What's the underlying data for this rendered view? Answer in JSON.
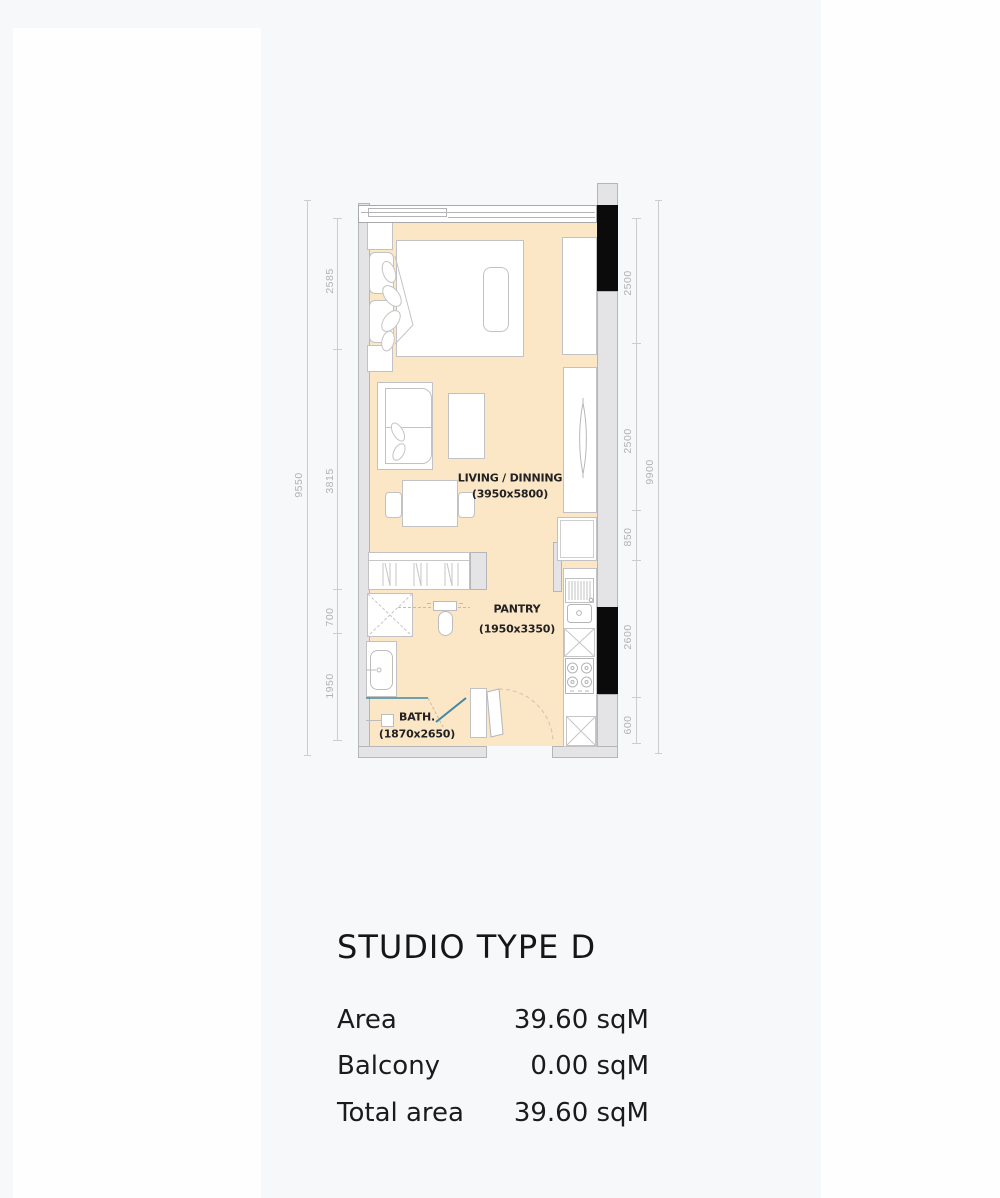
{
  "floorplan": {
    "rooms": {
      "living": {
        "name": "LIVING / DINNING",
        "size": "(3950x5800)"
      },
      "pantry": {
        "name": "PANTRY",
        "size": "(1950x3350)"
      },
      "bath": {
        "name": "BATH.",
        "size": "(1870x2650)"
      }
    },
    "dims": {
      "left_total": "9550",
      "left_1": "2585",
      "left_2": "3815",
      "left_3": "700",
      "left_4": "1950",
      "right_1": "2500",
      "right_2": "2500",
      "right_3": "850",
      "right_4": "2600",
      "right_5": "600",
      "right_total": "9900"
    },
    "colors": {
      "floor": "#fbe6c5",
      "wall": "#e4e4e6",
      "column": "#0b0b0b",
      "line": "#c2c2c4",
      "dim_text": "#b2b2b4",
      "accent_teal": "#3f88a5"
    }
  },
  "info": {
    "title": "STUDIO TYPE D",
    "rows": [
      {
        "label": "Area",
        "value": "39.60 sqM"
      },
      {
        "label": "Balcony",
        "value": "0.00 sqM"
      },
      {
        "label": "Total area",
        "value": "39.60 sqM"
      }
    ]
  }
}
